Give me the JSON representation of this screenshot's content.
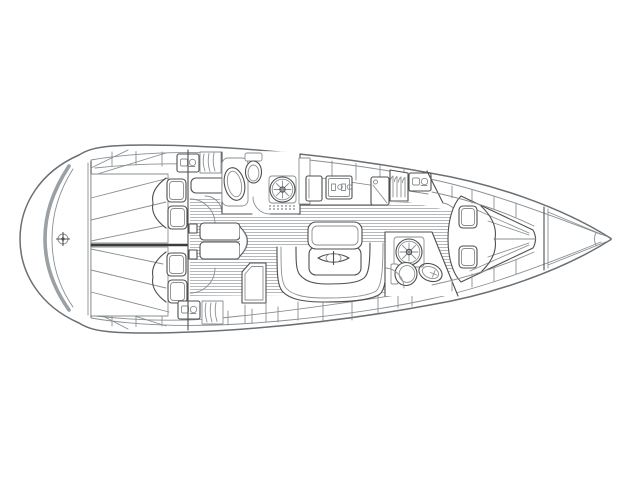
{
  "page": {
    "background": "#ffffff",
    "description": "Sailing yacht interior layout plan, top view, bow pointing right"
  },
  "diagram": {
    "type": "boat-floorplan",
    "style": "black-and-white technical line drawing",
    "orientation": "bow-right",
    "colors": {
      "background": "#ffffff",
      "line": "#4f4f4f",
      "line_light": "#8a8f92",
      "hull_accent": "#9aa0a4",
      "floor_hatch": "#b5b9bb"
    },
    "areas": [
      {
        "id": "hull",
        "label": "Hull outline"
      },
      {
        "id": "stern-platform",
        "label": "Stern with transom and swim platform"
      },
      {
        "id": "aft-cabin-port",
        "label": "Aft double cabin (port)"
      },
      {
        "id": "aft-cabin-starboard",
        "label": "Aft double cabin (starboard)"
      },
      {
        "id": "companionway",
        "label": "Companionway steps"
      },
      {
        "id": "aft-head",
        "label": "Aft head with WC, washbasin and vent hatch"
      },
      {
        "id": "galley",
        "label": "Galley with stove, fridge and lockers"
      },
      {
        "id": "saloon",
        "label": "Saloon with U-shaped settee and folding table"
      },
      {
        "id": "nav-station",
        "label": "Chart table / navigation station"
      },
      {
        "id": "forward-head",
        "label": "Forward head with WC, washbasin and vent hatch"
      },
      {
        "id": "forward-cabin",
        "label": "Forward V-berth cabin"
      },
      {
        "id": "foredeck",
        "label": "Bow / anchor locker"
      }
    ],
    "features": [
      "double-berth",
      "pillows",
      "mattress-quilting",
      "vent-hatch-fan",
      "toilet",
      "washbasin",
      "stove-burners",
      "hanging-locker",
      "locker-shelves",
      "door-swing-arcs",
      "teak-sole-hatching",
      "folding-table-symbol",
      "transom-fitting"
    ]
  }
}
